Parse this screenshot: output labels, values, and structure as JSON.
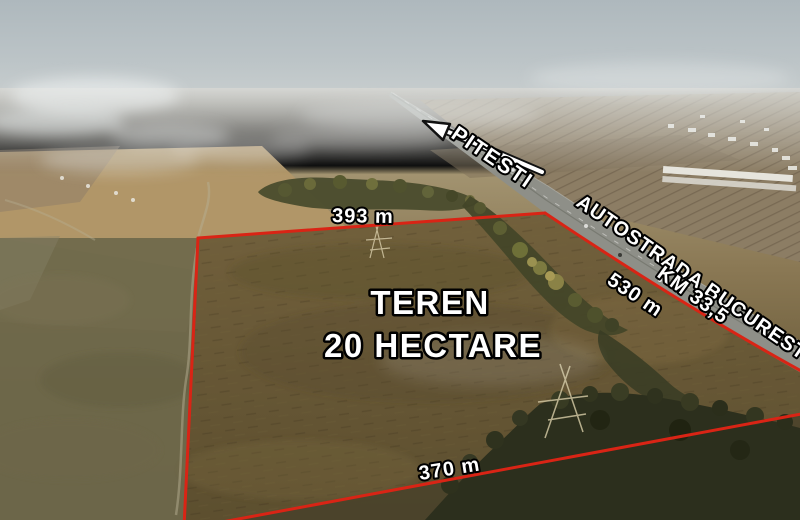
{
  "labels": {
    "direction": "PITESTI",
    "highway_name": "AUTOSTRADA BUCURESTI - PITESTI",
    "km_marker": "KM 33,5",
    "side_east": "530 m",
    "side_north": "393 m",
    "side_south": "370 m",
    "plot_line1": "TEREN",
    "plot_line2": "20 HECTARE"
  },
  "colors": {
    "boundary": "#d92415",
    "label_fill": "#ffffff",
    "label_outline": "#000000",
    "sky": "#b3bcc1",
    "haze": "#ccd2d3",
    "field_far": "#95897a",
    "field_gold": "#b19768",
    "field_left": "#6e684b",
    "plot_field": "#6a5a39",
    "trees_dark": "#434628",
    "highway_gray": "#8e8f88",
    "trees_bottom": "#2c2f1d"
  }
}
